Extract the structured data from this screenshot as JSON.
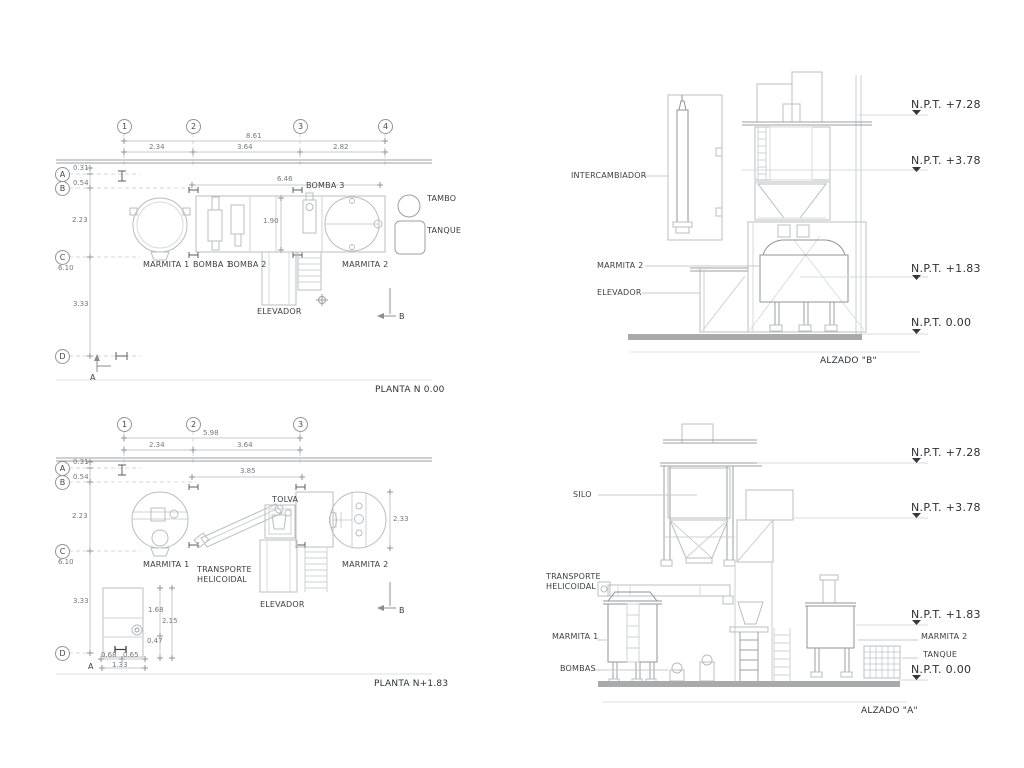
{
  "plan_top": {
    "title": "PLANTA N 0.00",
    "grid_cols": [
      "1",
      "2",
      "3",
      "4"
    ],
    "grid_rows": [
      "A",
      "B",
      "C",
      "D"
    ],
    "dim_total": "8.61",
    "dim_seg1": "2.34",
    "dim_seg2": "3.64",
    "dim_seg3": "2.82",
    "dim_equip": "6.46",
    "dim_inner": "1.90",
    "dim_a": "0.31",
    "dim_ab": "0.54",
    "dim_bc": "2.23",
    "dim_v_total": "6.10",
    "dim_cd": "3.33",
    "lbl_marmita1": "MARMITA 1",
    "lbl_bomba1": "BOMBA 1",
    "lbl_bomba2": "BOMBA 2",
    "lbl_bomba3": "BOMBA 3",
    "lbl_marmita2": "MARMITA 2",
    "lbl_tambo": "TAMBO",
    "lbl_tanque": "TANQUE",
    "lbl_elevador": "ELEVADOR",
    "sec_a": "A",
    "sec_b": "B"
  },
  "plan_bottom": {
    "title": "PLANTA N+1.83",
    "grid_cols": [
      "1",
      "2",
      "3"
    ],
    "grid_rows": [
      "A",
      "B",
      "C",
      "D"
    ],
    "dim_total": "5.98",
    "dim_seg1": "2.34",
    "dim_seg2": "3.64",
    "dim_equip": "3.85",
    "dim_a": "0.31",
    "dim_ab": "0.54",
    "dim_bc": "2.23",
    "dim_v_total": "6.10",
    "dim_cd": "3.33",
    "dim_right": "2.33",
    "dim_r1": "1.68",
    "dim_r2": "2.15",
    "dim_r3": "0.47",
    "dim_b1": "0.68",
    "dim_b2": "0.65",
    "dim_b3": "1.33",
    "lbl_marmita1": "MARMITA 1",
    "lbl_transporte": "TRANSPORTE HELICOIDAL",
    "lbl_tolva": "TOLVA",
    "lbl_marmita2": "MARMITA 2",
    "lbl_elevador": "ELEVADOR",
    "sec_a": "A",
    "sec_b": "B"
  },
  "elev_b": {
    "title": "ALZADO \"B\"",
    "npt_728": "N.P.T. +7.28",
    "npt_378": "N.P.T. +3.78",
    "npt_183": "N.P.T. +1.83",
    "npt_000": "N.P.T. 0.00",
    "lbl_intercambiador": "INTERCAMBIADOR",
    "lbl_marmita2": "MARMITA 2",
    "lbl_elevador": "ELEVADOR"
  },
  "elev_a": {
    "title": "ALZADO \"A\"",
    "npt_728": "N.P.T. +7.28",
    "npt_378": "N.P.T. +3.78",
    "npt_183": "N.P.T. +1.83",
    "npt_000": "N.P.T. 0.00",
    "lbl_silo": "SILO",
    "lbl_transporte": "TRANSPORTE HELICOIDAL",
    "lbl_marmita1": "MARMITA 1",
    "lbl_bombas": "BOMBAS",
    "lbl_marmita2": "MARMITA 2",
    "lbl_tanque": "TANQUE"
  },
  "colors": {
    "line": "#b9bdc1",
    "wall": "#9aa0a4",
    "text": "#3b3f43",
    "ground": "#a8aaac"
  }
}
